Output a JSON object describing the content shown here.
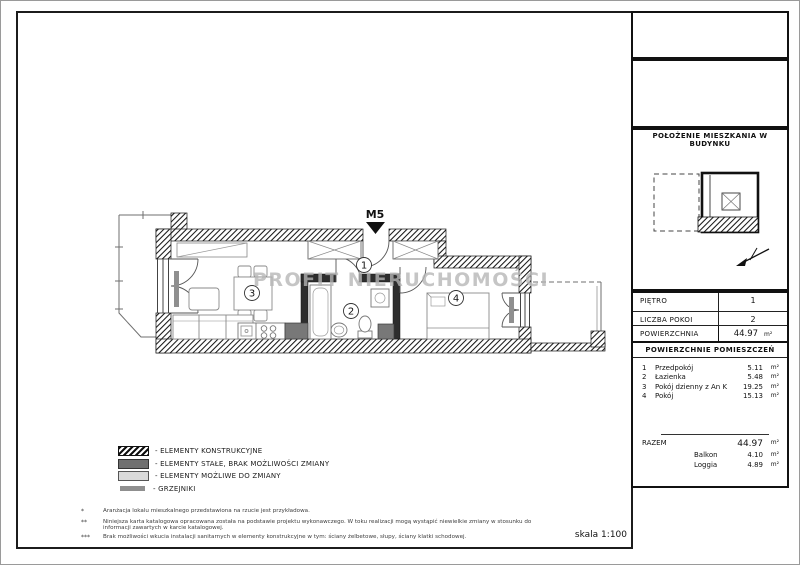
{
  "plan": {
    "unit_label": "M5",
    "watermark": "PROFIT NIERUCHOMOŚCI",
    "rooms": [
      {
        "num": "1"
      },
      {
        "num": "2"
      },
      {
        "num": "3"
      },
      {
        "num": "4"
      }
    ],
    "scale_label": "skala 1:100"
  },
  "legend": {
    "items": [
      {
        "swatch": "hatched",
        "label": "- ELEMENTY KONSTRUKCYJNE"
      },
      {
        "swatch": "dark-gray",
        "label": "- ELEMENTY STAŁE, BRAK MOŻLIWOŚCI ZMIANY"
      },
      {
        "swatch": "light-gray",
        "label": "- ELEMENTY MOŻLIWE DO ZMIANY"
      },
      {
        "swatch": "gray-bar",
        "label": "- GRZEJNIKI"
      }
    ]
  },
  "footnotes": [
    {
      "marker": "*",
      "text": "Aranżacja lokalu mieszkalnego przedstawiona na rzucie jest przykładowa."
    },
    {
      "marker": "**",
      "text": "Niniejsza karta katalogowa opracowana została na podstawie projektu wykonawczego. W toku realizacji mogą wystąpić niewielkie zmiany w stosunku do informacji zawartych w karcie katalogowej."
    },
    {
      "marker": "***",
      "text": "Brak możliwości wkucia instalacji sanitarnych w elementy konstrukcyjne w tym: ściany żelbetowe, słupy, ściany klatki schodowej."
    }
  ],
  "sidebar": {
    "location_title": "POŁOŻENIE MIESZKANIA W BUDYNKU",
    "info_rows": [
      {
        "label": "PIĘTRO",
        "value": "1"
      },
      {
        "label": "LICZBA POKOI",
        "value": "2"
      },
      {
        "label": "POWIERZCHNIA",
        "value": "44.97",
        "unit": "m²"
      }
    ],
    "rooms_title": "POWIERZCHNIE POMIESZCZEŃ",
    "rooms": [
      {
        "no": "1",
        "name": "Przedpokój",
        "area": "5.11",
        "unit": "m²"
      },
      {
        "no": "2",
        "name": "Łazienka",
        "area": "5.48",
        "unit": "m²"
      },
      {
        "no": "3",
        "name": "Pokój dzienny z An K",
        "area": "19.25",
        "unit": "m²"
      },
      {
        "no": "4",
        "name": "Pokój",
        "area": "15.13",
        "unit": "m²"
      }
    ],
    "total": {
      "label": "RAZEM",
      "value": "44.97",
      "unit": "m²"
    },
    "extras": [
      {
        "name": "Balkon",
        "area": "4.10",
        "unit": "m²"
      },
      {
        "name": "Loggia",
        "area": "4.89",
        "unit": "m²"
      }
    ]
  },
  "colors": {
    "wall": "#161616",
    "fixed_element": "#787878",
    "changeable_element": "#dadada",
    "radiator": "#8f8f8f",
    "watermark": "#b5b5b5"
  }
}
